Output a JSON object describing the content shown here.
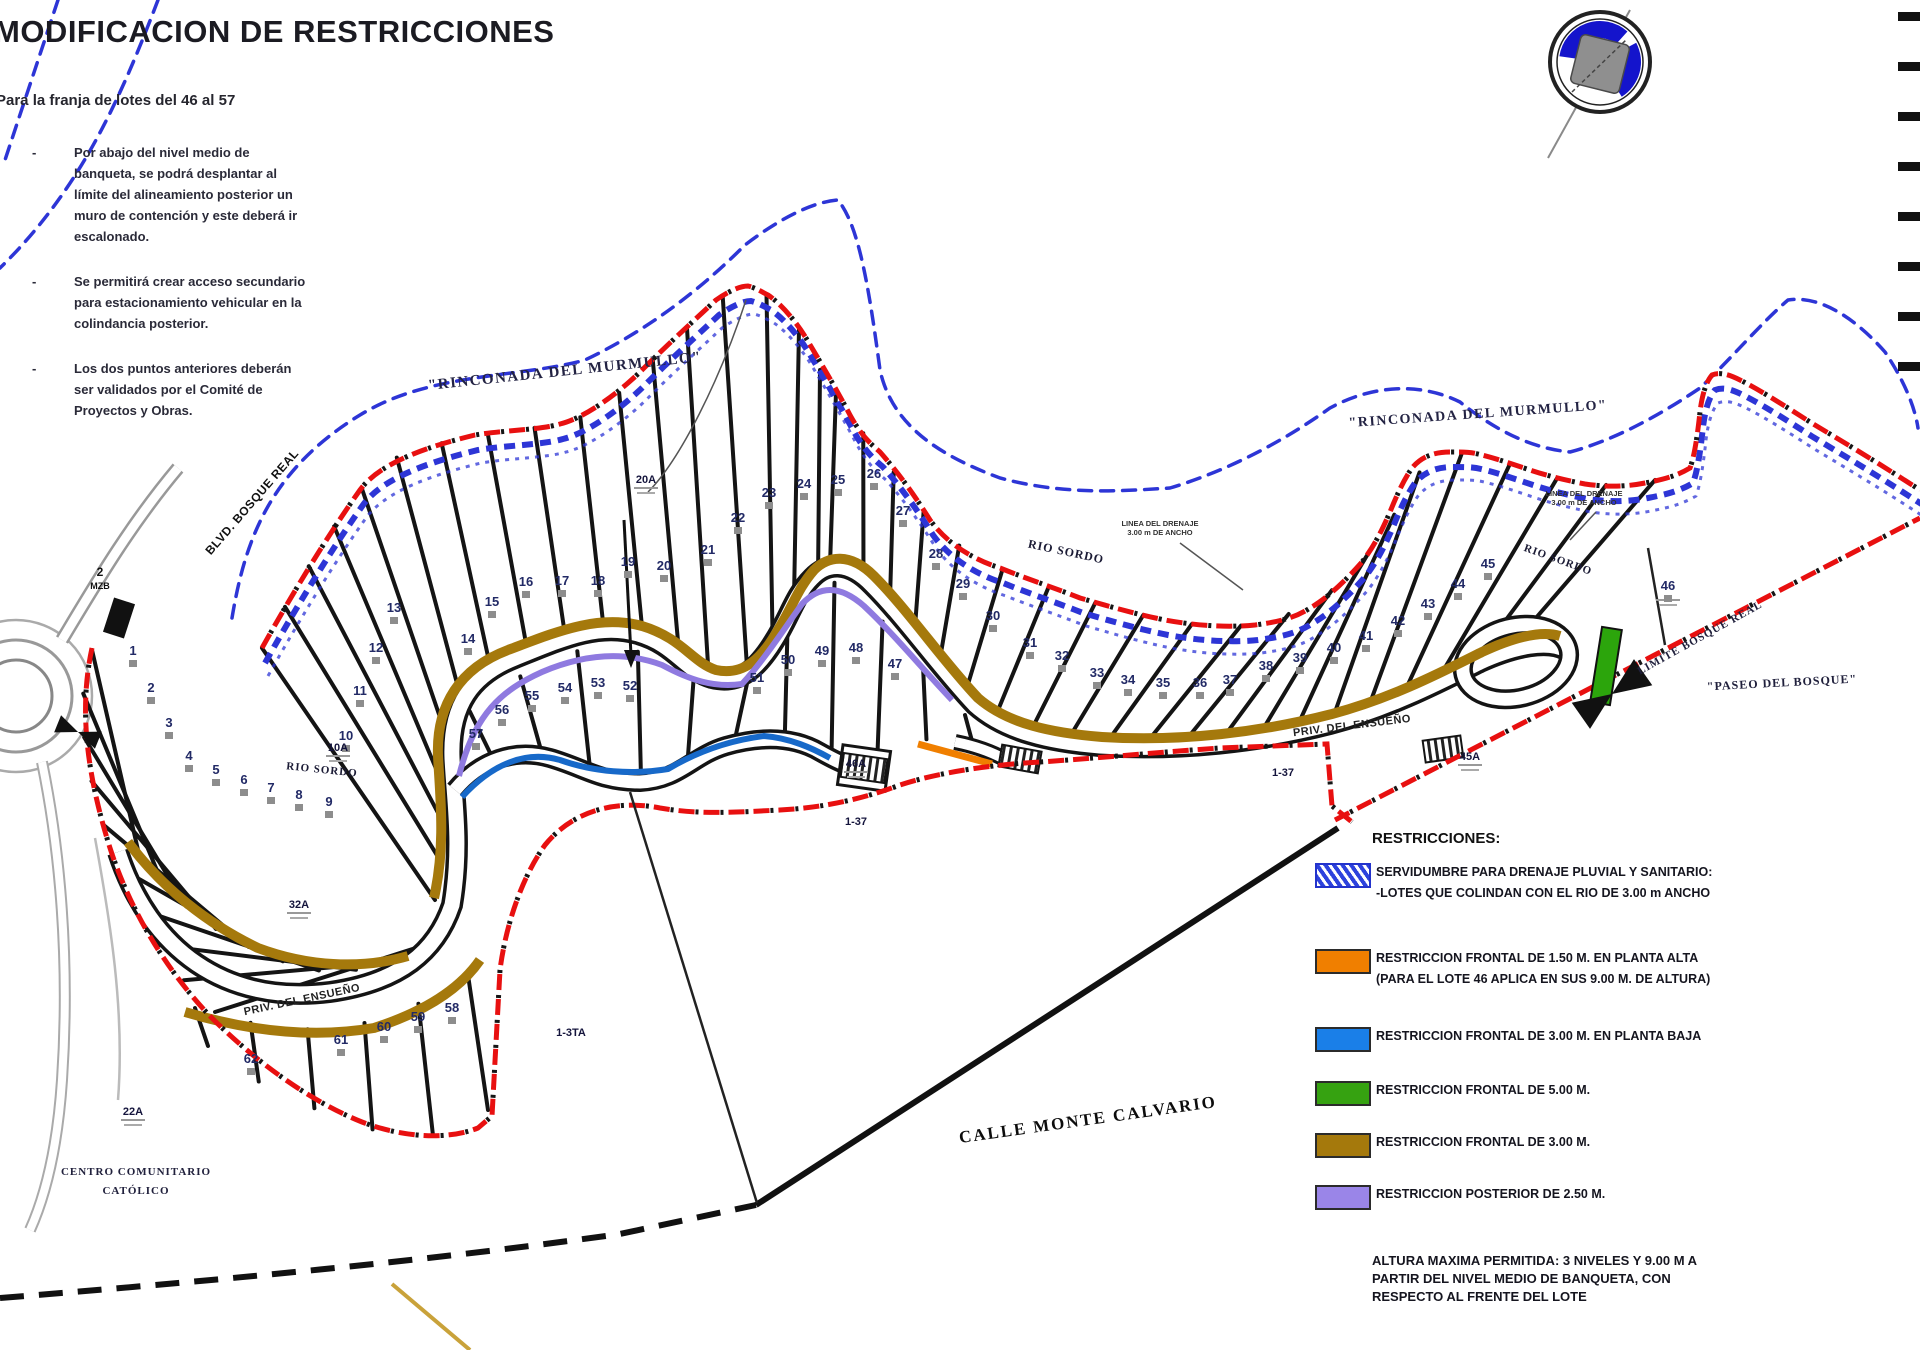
{
  "header": {
    "title": "MODIFICACION DE RESTRICCIONES",
    "subtitle": "Para la franja de lotes del 46 al 57"
  },
  "notes": [
    "Por abajo del nivel medio de banqueta, se podrá desplantar al límite del alineamiento posterior un muro de contención y este deberá ir escalonado.",
    "Se permitirá crear acceso secundario para estacionamiento vehicular en la colindancia posterior.",
    "Los dos puntos anteriores deberán ser validados por el Comité de Proyectos y Obras."
  ],
  "legend": {
    "title": "RESTRICCIONES:",
    "items": [
      {
        "swatch": "hatch",
        "color": "#2d42dd",
        "lines": [
          "SERVIDUMBRE PARA DRENAJE PLUVIAL Y SANITARIO:",
          "-LOTES QUE COLINDAN CON EL RIO DE 3.00 m ANCHO"
        ]
      },
      {
        "swatch": "solid",
        "color": "#f07f00",
        "lines": [
          "RESTRICCION FRONTAL DE 1.50 M. EN PLANTA ALTA",
          "(PARA EL LOTE 46 APLICA EN SUS 9.00 M. DE ALTURA)"
        ]
      },
      {
        "swatch": "solid",
        "color": "#1a7fe8",
        "lines": [
          "RESTRICCION FRONTAL DE 3.00 M. EN PLANTA BAJA"
        ]
      },
      {
        "swatch": "solid",
        "color": "#36a211",
        "lines": [
          "RESTRICCION FRONTAL DE 5.00 M."
        ]
      },
      {
        "swatch": "solid",
        "color": "#a5790c",
        "lines": [
          "RESTRICCION FRONTAL DE 3.00 M."
        ]
      },
      {
        "swatch": "solid",
        "color": "#9a85e8",
        "lines": [
          "RESTRICCION POSTERIOR DE 2.50 M."
        ]
      }
    ],
    "height_note": [
      "ALTURA MAXIMA PERMITIDA: 3 NIVELES Y 9.00 M A",
      "PARTIR DEL NIVEL MEDIO DE BANQUETA, CON",
      "RESPECTO AL FRENTE DEL LOTE"
    ]
  },
  "map": {
    "colors": {
      "boundary_red": "#e81010",
      "river_blue": "#2d35d6",
      "band_gold": "#a5790c",
      "band_purple": "#8f7ae0",
      "band_blue": "#1769c9",
      "band_orange": "#f07f00",
      "band_green": "#2ca50c"
    },
    "street_labels": [
      {
        "id": "rinconada1",
        "text": "\"RINCONADA DEL MURMULLO\""
      },
      {
        "id": "rinconada2",
        "text": "\"RINCONADA DEL MURMULLO\""
      },
      {
        "id": "rio1",
        "text": "RIO SORDO"
      },
      {
        "id": "rio2",
        "text": "RIO SORDO"
      },
      {
        "id": "rio3",
        "text": "RIO SORDO"
      },
      {
        "id": "priv1",
        "text": "PRIV. DEL ENSUEÑO"
      },
      {
        "id": "priv2",
        "text": "PRIV. DEL ENSUEÑO"
      },
      {
        "id": "calle",
        "text": "CALLE MONTE CALVARIO"
      },
      {
        "id": "centro1",
        "text": "CENTRO COMUNITARIO"
      },
      {
        "id": "centro2",
        "text": "CATÓLICO"
      },
      {
        "id": "paseo",
        "text": "\"PASEO DEL BOSQUE\""
      },
      {
        "id": "limite",
        "text": "LIMITE BOSQUE REAL"
      },
      {
        "id": "blvd",
        "text": "BLVD. BOSQUE REAL"
      },
      {
        "id": "mzb1",
        "text": "2"
      },
      {
        "id": "mzb2",
        "text": "MZB"
      }
    ],
    "area_labels": [
      {
        "id": "s20A",
        "text": "20A"
      },
      {
        "id": "s10A",
        "text": "10A"
      },
      {
        "id": "s22A",
        "text": "22A"
      },
      {
        "id": "s32A",
        "text": "32A"
      },
      {
        "id": "s46A",
        "text": "46A"
      },
      {
        "id": "s45A",
        "text": "45A"
      },
      {
        "id": "s137a",
        "text": "1-37"
      },
      {
        "id": "s137b",
        "text": "1-37"
      },
      {
        "id": "s13ta",
        "text": "1-3TA"
      }
    ],
    "annotations": [
      {
        "id": "drain1",
        "lines": [
          "LINEA DEL DRENAJE",
          "3.00 m DE ANCHO"
        ]
      },
      {
        "id": "drain2",
        "lines": [
          "LINEA DEL DRENAJE",
          "3.00 m DE ANCHO"
        ]
      }
    ],
    "lots": {
      "upper_left": [
        "10",
        "11",
        "12",
        "13",
        "14",
        "15",
        "16",
        "17",
        "18",
        "19",
        "20",
        "21",
        "22",
        "23",
        "24",
        "25"
      ],
      "upper_right": [
        "26",
        "27",
        "28",
        "29",
        "30",
        "31",
        "32",
        "33",
        "34",
        "35",
        "36",
        "37",
        "38",
        "39",
        "40",
        "41",
        "42",
        "43",
        "44",
        "45"
      ],
      "middle": [
        "47",
        "48",
        "49",
        "50",
        "51",
        "52",
        "53",
        "54",
        "55",
        "56",
        "57"
      ],
      "left": [
        "1",
        "2",
        "3",
        "4",
        "5",
        "6",
        "7",
        "8",
        "9"
      ],
      "lower_left": [
        "58",
        "59",
        "60",
        "61",
        "62"
      ],
      "lot46": [
        "46"
      ]
    },
    "compass": {
      "name": "north-arrow"
    }
  }
}
